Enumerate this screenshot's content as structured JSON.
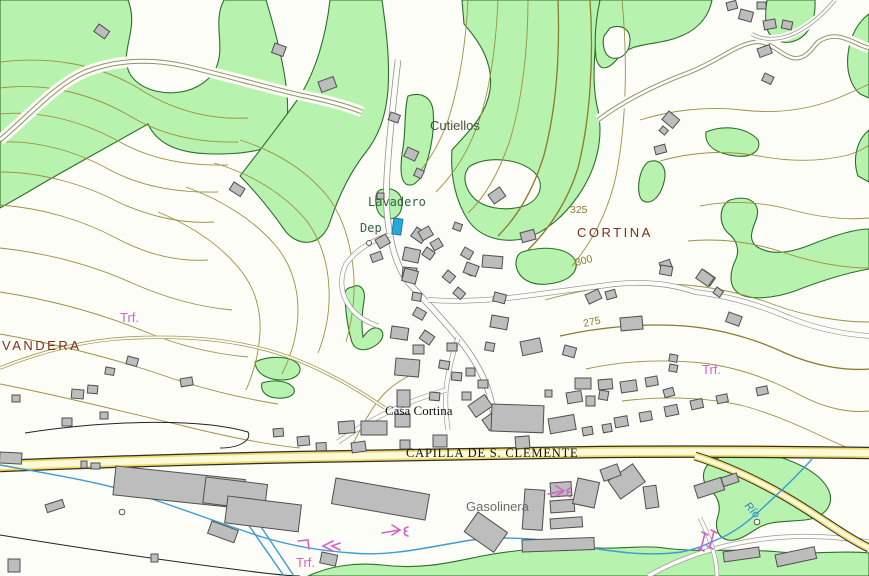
{
  "map": {
    "labels": {
      "cutiellos": "Cutiellos",
      "lavadero": "Lavadero",
      "dep": "Dep",
      "cortina": "CORTINA",
      "vandera": "VANDERA",
      "casa_cortina": "Casa Cortina",
      "capilla": "CAPILLA DE S. CLEMENTE",
      "gasolinera": "Gasolinera",
      "rio": "Río",
      "trf_left": "Trf.",
      "trf_right": "Trf.",
      "trf_bottom": "Trf.",
      "elev_325": "325",
      "elev_300": "300",
      "elev_275": "275"
    },
    "colors": {
      "vegetation_fill": "#b7f2ae",
      "vegetation_outline": "#2c6e2c",
      "contour": "#9e9040",
      "contour_index": "#8a7c28",
      "water": "#3d9bd5",
      "road_casing": "#2e2e2e",
      "road_yellow": "#eedc5e",
      "road_fill": "#fdf9dc",
      "building_fill": "#bdbdbd",
      "building_outline": "#4f4f4f",
      "label_brown": "#7b2f1e",
      "label_olive": "#8a7c2e",
      "label_green": "#356147",
      "label_pink": "#d163c8",
      "label_gray": "#6b6b6b",
      "deposit_blue": "#29a8dc"
    }
  }
}
